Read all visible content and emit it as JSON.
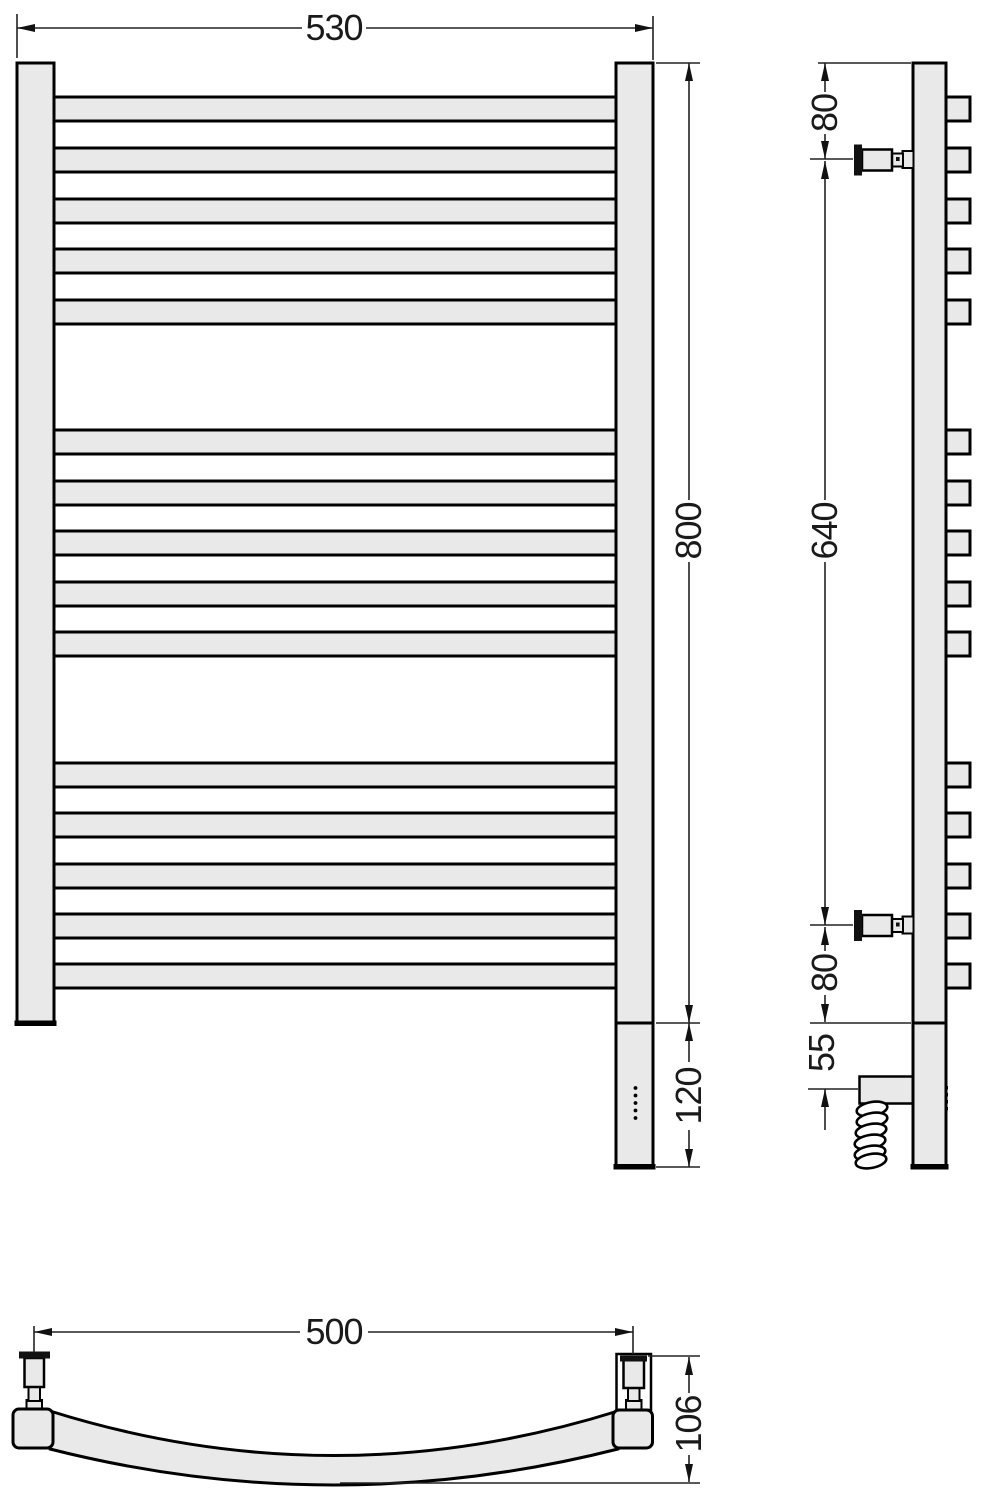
{
  "colors": {
    "object_fill": "#e9e9e9",
    "outline": "#000000",
    "dimension_line": "#222222",
    "background": "#ffffff"
  },
  "front_view": {
    "width_label": "530",
    "height_label": "800",
    "heater_section_label": "120",
    "rung_tops": [
      97,
      148,
      199,
      249,
      300,
      430,
      481,
      531,
      582,
      632,
      763,
      813,
      864,
      914,
      964
    ],
    "rung_height": 24,
    "rung_x": 52,
    "rung_width": 566,
    "indicator_dots": {
      "count": 5,
      "cx": 635.5,
      "start_y": 1088,
      "step": 7.5,
      "r": 1.9
    }
  },
  "side_view": {
    "top_offset_label": "80",
    "mount_span_label": "640",
    "bottom_offset_label": "80",
    "cable_entry_label": "55",
    "stub_x": 944,
    "stub_width": 26,
    "indicator_dots": {
      "count": 4,
      "x": 944.6,
      "start_y": 1086,
      "step": 7,
      "size": 3.4
    }
  },
  "bottom_view": {
    "mount_span_label": "500",
    "depth_label": "106"
  }
}
